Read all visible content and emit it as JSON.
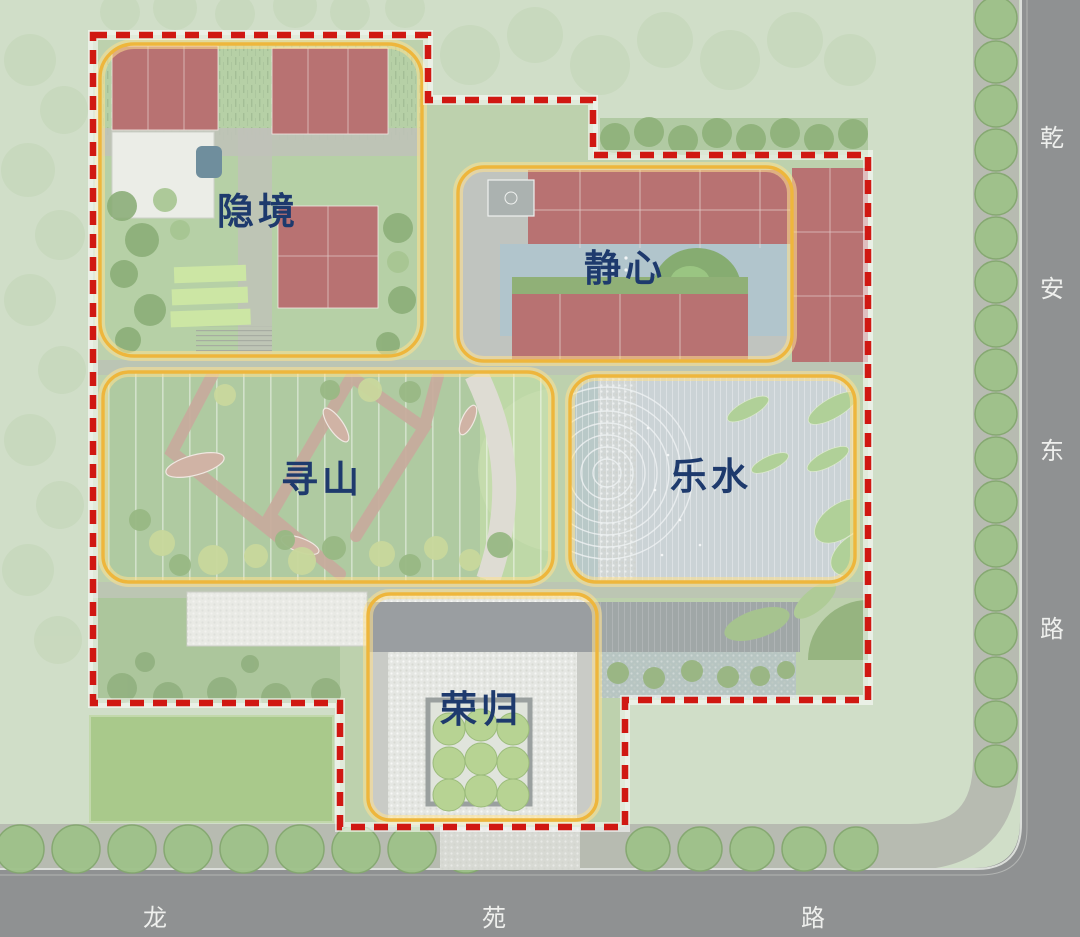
{
  "plan": {
    "type": "landscape-master-plan",
    "zones": [
      {
        "id": "yinjing",
        "label": "隐境"
      },
      {
        "id": "jingxin",
        "label": "静心"
      },
      {
        "id": "xunshan",
        "label": "寻山"
      },
      {
        "id": "leshui",
        "label": "乐水"
      },
      {
        "id": "ronggui",
        "label": "荣归"
      }
    ],
    "roads": {
      "east": {
        "name": "乾安东路",
        "chars": [
          "乾",
          "安",
          "东",
          "路"
        ]
      },
      "south": {
        "name": "龙苑路",
        "chars": [
          "龙",
          "苑",
          "路"
        ]
      }
    },
    "colors": {
      "boundary_red": "#d01812",
      "zone_outline_yellow": "#eeb63c",
      "zone_glow_yellow": "#ffe18f",
      "label_navy": "#1e3a6d",
      "road_gray": "#8f9192",
      "sidewalk_gray": "#b7bbb1",
      "building_red": "#b06363",
      "pool_blue": "#a9bfc7",
      "lawn_green": "#a8c88a",
      "site_green": "#b6cca4"
    }
  }
}
